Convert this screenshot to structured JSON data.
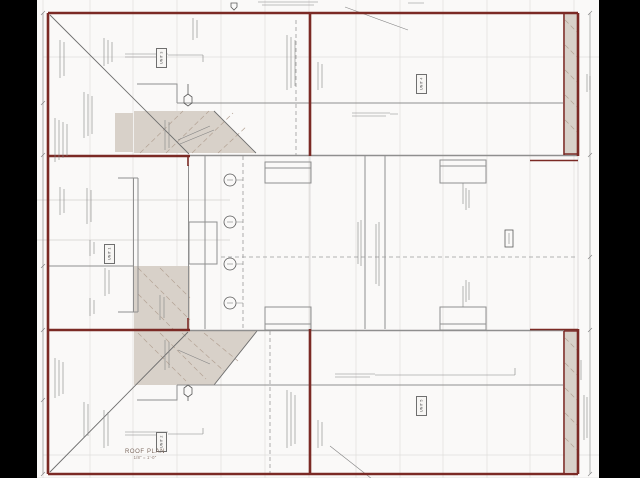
{
  "drawing": {
    "type": "architectural roof plan sheet",
    "title": "ROOF PLAN",
    "scale": "1/8\" = 1'-0\""
  },
  "unit_labels": [
    {
      "label": "UNIT 3"
    },
    {
      "label": "UNIT 4"
    },
    {
      "label": "UNIT 1"
    },
    {
      "label": "UNIT 5"
    },
    {
      "label": "UNIT 2"
    }
  ],
  "colors": {
    "background": "#000000",
    "sheet": "#faf9f8",
    "wall": "#7b2a25",
    "hatch_fill": "#d8d1c9",
    "hatch_line": "#b3a294",
    "grid": "#e0dedc",
    "line": "#8f8f8f",
    "annotation": "#848484"
  },
  "symbols": {
    "grid_bubble_count": 4,
    "roof_drain": "hexagon",
    "north_flag": "pentagon",
    "revision_triangle": "triangle"
  }
}
